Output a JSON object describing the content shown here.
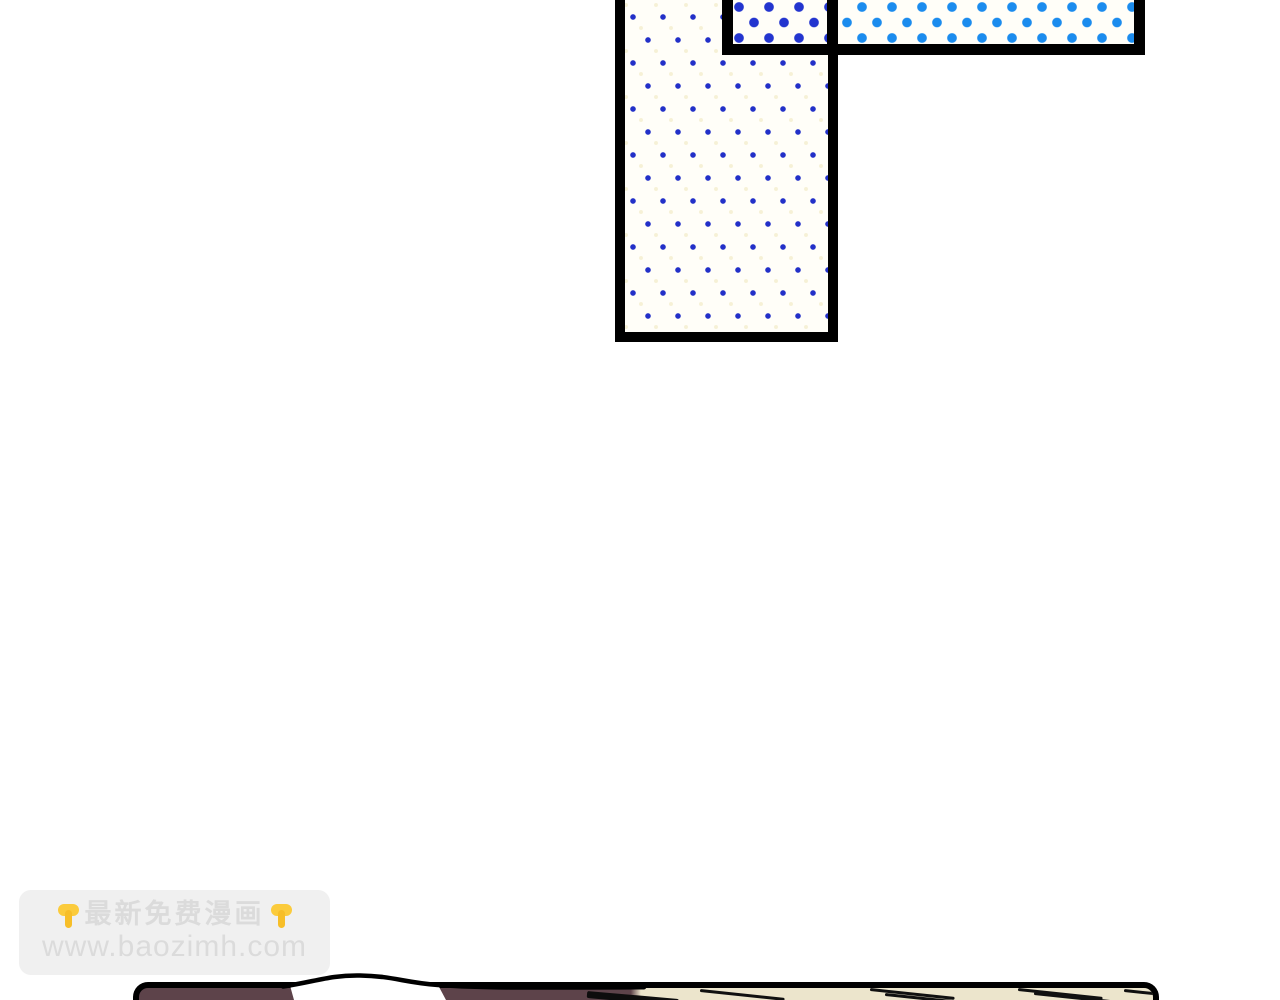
{
  "watermark": {
    "line1": "最新免费漫画",
    "line2": "www.baozimh.com",
    "left_icon": "point-down-emoji",
    "right_icon": "point-down-emoji"
  },
  "panels": {
    "vertical_panel": "halftone-small-blue-dots",
    "horizontal_bar": "halftone-large-blue-dots-gradient",
    "bottom_panel": "maroon-to-cream-with-hatching",
    "bubble": "white-dome-outline"
  },
  "colors": {
    "page-bg": "#FFFFFF",
    "panel-border": "#000000",
    "halftone-bg": "#FFFEF8",
    "halftone-accent": "#F6F1D6",
    "halftone-dot-small": "#2230C8",
    "halftone-dot-dark": "#2335CF",
    "halftone-dot-bright": "#1B8CEE",
    "bottom-maroon": "#5D434A",
    "bottom-cream": "#ECE5CC",
    "watermark-bg": "#F0F0F0",
    "watermark-text": "#DBDBDB",
    "emoji-yellow": "#FBCB3C",
    "emoji-yellow-dark": "#F7BE28"
  }
}
